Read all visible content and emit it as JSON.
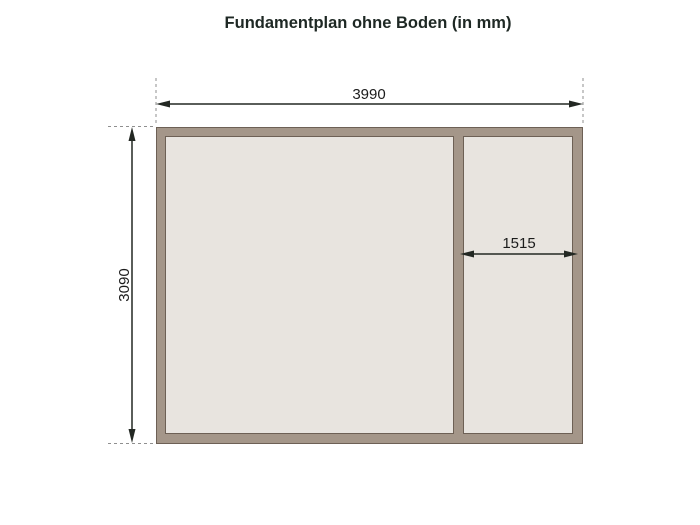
{
  "title": "Fundamentplan ohne Boden (in mm)",
  "diagram": {
    "unit": "mm",
    "outer_width_label": "3990",
    "outer_depth_label": "3090",
    "partition_width_label": "1515",
    "colors": {
      "background": "#ffffff",
      "beam": "#a49689",
      "beam_outline": "#6d6055",
      "panel": "#e8e4df",
      "dimension_line": "#232823",
      "extension_line": "#8f8f8f",
      "dimension_text": "#1c1c1c",
      "title_text": "#1e2824"
    }
  }
}
